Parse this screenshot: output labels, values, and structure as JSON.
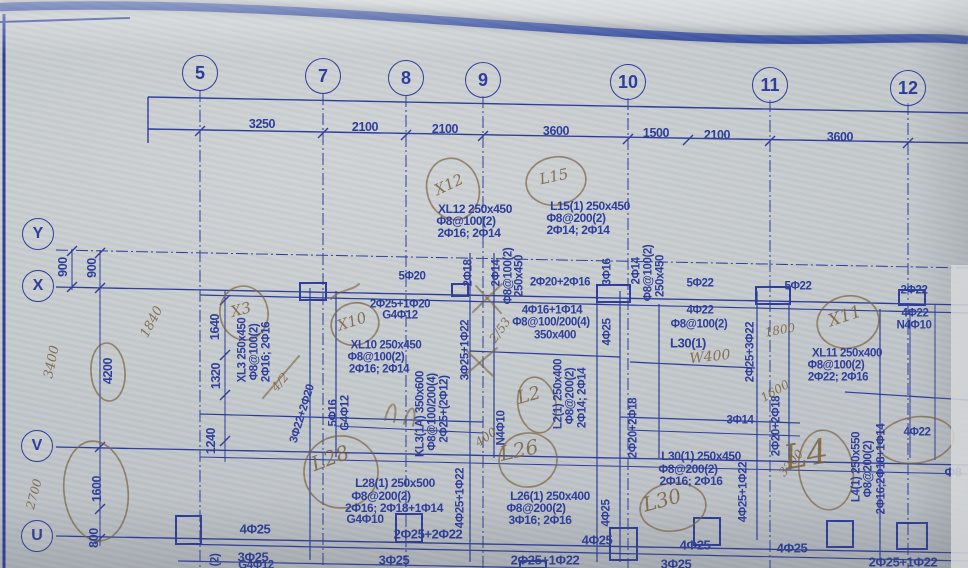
{
  "meta": {
    "description": "Photographed structural beam reinforcement layout blueprint with handwritten site markups"
  },
  "colors": {
    "ink": "#2c3c9b",
    "band": "#1d3795",
    "pen": "rgba(122,95,60,0.8)",
    "paper": "#c6cbce"
  },
  "grid": {
    "top_bubbles": [
      {
        "t": "5",
        "x": 200,
        "y": 73
      },
      {
        "t": "7",
        "x": 323,
        "y": 76
      },
      {
        "t": "8",
        "x": 406,
        "y": 78
      },
      {
        "t": "9",
        "x": 483,
        "y": 80
      },
      {
        "t": "10",
        "x": 628,
        "y": 82
      },
      {
        "t": "11",
        "x": 770,
        "y": 85
      },
      {
        "t": "12",
        "x": 908,
        "y": 88
      }
    ],
    "left_bubbles": [
      {
        "t": "Y",
        "x": 38,
        "y": 234
      },
      {
        "t": "X",
        "x": 38,
        "y": 286
      },
      {
        "t": "V",
        "x": 37,
        "y": 446
      },
      {
        "t": "U",
        "x": 37,
        "y": 536
      }
    ]
  },
  "dimensions": {
    "top": [
      {
        "t": "3250",
        "x": 262,
        "y": 124
      },
      {
        "t": "2100",
        "x": 365,
        "y": 127
      },
      {
        "t": "2100",
        "x": 445,
        "y": 129
      },
      {
        "t": "3600",
        "x": 556,
        "y": 131
      },
      {
        "t": "1500",
        "x": 656,
        "y": 133
      },
      {
        "t": "2100",
        "x": 717,
        "y": 135
      },
      {
        "t": "3600",
        "x": 840,
        "y": 137
      }
    ],
    "left": [
      {
        "t": "900",
        "x": 63,
        "y": 267,
        "r": -90
      },
      {
        "t": "900",
        "x": 92,
        "y": 268,
        "r": -90
      },
      {
        "t": "4200",
        "x": 108,
        "y": 371,
        "r": -90
      },
      {
        "t": "1600",
        "x": 97,
        "y": 489,
        "r": -90
      },
      {
        "t": "800",
        "x": 94,
        "y": 538,
        "r": -90
      },
      {
        "t": "1640",
        "x": 215,
        "y": 327,
        "r": -90
      },
      {
        "t": "1320",
        "x": 216,
        "y": 376,
        "r": -90
      },
      {
        "t": "1240",
        "x": 211,
        "y": 441,
        "r": -90
      }
    ]
  },
  "print_labels": [
    {
      "t": "XL12 250x450",
      "x": 475,
      "y": 209,
      "s": 12
    },
    {
      "t": "Φ8@100(2)",
      "x": 466,
      "y": 221,
      "s": 12
    },
    {
      "t": "2Φ16; 2Φ14",
      "x": 469,
      "y": 233,
      "s": 12
    },
    {
      "t": "L15(1) 250x450",
      "x": 590,
      "y": 206,
      "s": 12
    },
    {
      "t": "Φ8@200(2)",
      "x": 576,
      "y": 218,
      "s": 12
    },
    {
      "t": "2Φ14; 2Φ14",
      "x": 578,
      "y": 230,
      "s": 12
    },
    {
      "t": "5Φ20",
      "x": 412,
      "y": 277
    },
    {
      "t": "2Φ25+1Φ20",
      "x": 400,
      "y": 305
    },
    {
      "t": "G4Φ12",
      "x": 400,
      "y": 316
    },
    {
      "t": "XL10 250x450",
      "x": 386,
      "y": 346
    },
    {
      "t": "Φ8@100(2)",
      "x": 376,
      "y": 358
    },
    {
      "t": "2Φ16; 2Φ14",
      "x": 379,
      "y": 370
    },
    {
      "t": "2Φ20+2Φ16",
      "x": 560,
      "y": 283
    },
    {
      "t": "4Φ16+1Φ14",
      "x": 552,
      "y": 311
    },
    {
      "t": "Φ8@100/200(4)",
      "x": 551,
      "y": 323
    },
    {
      "t": "350x400",
      "x": 555,
      "y": 336
    },
    {
      "t": "5Φ22",
      "x": 700,
      "y": 284
    },
    {
      "t": "5Φ22",
      "x": 798,
      "y": 287
    },
    {
      "t": "2Φ22",
      "x": 914,
      "y": 291
    },
    {
      "t": "4Φ22",
      "x": 700,
      "y": 311
    },
    {
      "t": "Φ8@100(2)",
      "x": 699,
      "y": 325
    },
    {
      "t": "L30(1)",
      "x": 688,
      "y": 343,
      "s": 13
    },
    {
      "t": "4Φ22",
      "x": 915,
      "y": 314
    },
    {
      "t": "N4Φ10",
      "x": 914,
      "y": 326
    },
    {
      "t": "XL11 250x400",
      "x": 847,
      "y": 354
    },
    {
      "t": "Φ8@100(2)",
      "x": 836,
      "y": 366
    },
    {
      "t": "2Φ22; 2Φ16",
      "x": 838,
      "y": 378
    },
    {
      "t": "L28(1) 250x500",
      "x": 395,
      "y": 483,
      "s": 12
    },
    {
      "t": "Φ8@200(2)",
      "x": 381,
      "y": 496,
      "s": 12
    },
    {
      "t": "2Φ16; 2Φ18+1Φ14",
      "x": 394,
      "y": 508,
      "s": 12
    },
    {
      "t": "G4Φ10",
      "x": 365,
      "y": 519,
      "s": 12
    },
    {
      "t": "L26(1) 250x400",
      "x": 550,
      "y": 496,
      "s": 12
    },
    {
      "t": "Φ8@200(2)",
      "x": 536,
      "y": 508,
      "s": 12
    },
    {
      "t": "3Φ16; 2Φ16",
      "x": 540,
      "y": 520,
      "s": 12
    },
    {
      "t": "L30(1) 250x450",
      "x": 701,
      "y": 456,
      "s": 12
    },
    {
      "t": "Φ8@200(2)",
      "x": 688,
      "y": 469,
      "s": 12
    },
    {
      "t": "2Φ16; 2Φ16",
      "x": 691,
      "y": 481,
      "s": 12
    },
    {
      "t": "3Φ14",
      "x": 740,
      "y": 421
    },
    {
      "t": "4Φ22",
      "x": 917,
      "y": 433
    },
    {
      "t": "Φ8",
      "x": 953,
      "y": 472,
      "s": 13
    },
    {
      "t": "4Φ25",
      "x": 255,
      "y": 529,
      "s": 13
    },
    {
      "t": "3Φ25",
      "x": 253,
      "y": 557,
      "s": 13
    },
    {
      "t": "G4Φ12",
      "x": 256,
      "y": 566
    },
    {
      "t": "2Φ25+2Φ22",
      "x": 428,
      "y": 534,
      "s": 13
    },
    {
      "t": "3Φ25",
      "x": 394,
      "y": 560,
      "s": 13
    },
    {
      "t": "4Φ25",
      "x": 597,
      "y": 540,
      "s": 13
    },
    {
      "t": "2Φ25+1Φ22",
      "x": 545,
      "y": 560,
      "s": 13
    },
    {
      "t": "4Φ25",
      "x": 695,
      "y": 545,
      "s": 13
    },
    {
      "t": "3Φ25",
      "x": 676,
      "y": 564,
      "s": 13
    },
    {
      "t": "4Φ25",
      "x": 792,
      "y": 548,
      "s": 13
    },
    {
      "t": "2Φ25+1Φ22",
      "x": 903,
      "y": 562,
      "s": 13
    },
    {
      "t": "2Φ18",
      "x": 469,
      "y": 273,
      "r": -90
    },
    {
      "t": "2Φ14",
      "x": 497,
      "y": 273,
      "r": -90
    },
    {
      "t": "Φ8@100(2)",
      "x": 509,
      "y": 276,
      "r": -90
    },
    {
      "t": "250x450",
      "x": 520,
      "y": 276,
      "r": -90
    },
    {
      "t": "3Φ16",
      "x": 608,
      "y": 272,
      "r": -90
    },
    {
      "t": "2Φ14",
      "x": 637,
      "y": 271,
      "r": -90
    },
    {
      "t": "Φ8@100(2)",
      "x": 649,
      "y": 273,
      "r": -90
    },
    {
      "t": "250x450",
      "x": 661,
      "y": 276,
      "r": -90
    },
    {
      "t": "XL3 250x450",
      "x": 243,
      "y": 350,
      "r": -90
    },
    {
      "t": "Φ8@100(2)",
      "x": 255,
      "y": 352,
      "r": -90
    },
    {
      "t": "2Φ16; 2Φ16",
      "x": 267,
      "y": 352,
      "r": -90
    },
    {
      "t": "3Φ25+1Φ22",
      "x": 466,
      "y": 350,
      "r": -90
    },
    {
      "t": "3Φ22+2Φ20",
      "x": 303,
      "y": 414,
      "r": -73
    },
    {
      "t": "5Φ16",
      "x": 334,
      "y": 413,
      "r": -90
    },
    {
      "t": "G4Φ12",
      "x": 346,
      "y": 413,
      "r": -90
    },
    {
      "t": "KL3(1A) 350x600",
      "x": 421,
      "y": 414,
      "r": -90
    },
    {
      "t": "Φ8@100/200(4)",
      "x": 433,
      "y": 412,
      "r": -90
    },
    {
      "t": "2Φ25+(2Φ12)",
      "x": 445,
      "y": 409,
      "r": -90
    },
    {
      "t": "L2(1) 250x400",
      "x": 559,
      "y": 394,
      "r": -90
    },
    {
      "t": "Φ8@200(2)",
      "x": 571,
      "y": 396,
      "r": -90
    },
    {
      "t": "2Φ14; 2Φ14",
      "x": 583,
      "y": 398,
      "r": -90
    },
    {
      "t": "N4Φ10",
      "x": 502,
      "y": 428,
      "r": -90
    },
    {
      "t": "4Φ25",
      "x": 608,
      "y": 332,
      "r": -90
    },
    {
      "t": "4Φ25",
      "x": 607,
      "y": 513,
      "r": -90
    },
    {
      "t": "4Φ25+1Φ22",
      "x": 461,
      "y": 498,
      "r": -90
    },
    {
      "t": "4Φ25+1Φ22",
      "x": 744,
      "y": 492,
      "r": -90
    },
    {
      "t": "2Φ25+3Φ22",
      "x": 751,
      "y": 352,
      "r": -90
    },
    {
      "t": "2Φ20+2Φ18",
      "x": 634,
      "y": 428,
      "r": -90
    },
    {
      "t": "2Φ20+2Φ18",
      "x": 777,
      "y": 426,
      "r": -90
    },
    {
      "t": "L4(1) 250x550",
      "x": 857,
      "y": 467,
      "r": -90
    },
    {
      "t": "Φ8@200(2)",
      "x": 869,
      "y": 469,
      "r": -90
    },
    {
      "t": "2Φ16;2Φ18+1Φ14",
      "x": 882,
      "y": 469,
      "r": -90
    },
    {
      "t": "(2)",
      "x": 216,
      "y": 560,
      "r": -90
    }
  ],
  "handwritten": {
    "notes": [
      {
        "t": "X12",
        "x": 449,
        "y": 185,
        "r": -25,
        "s": 15
      },
      {
        "t": "L15",
        "x": 554,
        "y": 177,
        "r": -12,
        "s": 15
      },
      {
        "t": "X10",
        "x": 352,
        "y": 322,
        "r": -18,
        "s": 15
      },
      {
        "t": "X3",
        "x": 241,
        "y": 310,
        "r": -15,
        "s": 15
      },
      {
        "t": "X11",
        "x": 845,
        "y": 317,
        "r": -18,
        "s": 17
      },
      {
        "t": "L28",
        "x": 330,
        "y": 458,
        "r": -20,
        "s": 20
      },
      {
        "t": "L2",
        "x": 529,
        "y": 396,
        "r": -15,
        "s": 18
      },
      {
        "t": "L26",
        "x": 519,
        "y": 450,
        "r": -12,
        "s": 20
      },
      {
        "t": "L30",
        "x": 662,
        "y": 500,
        "r": -15,
        "s": 20
      },
      {
        "t": "L4",
        "x": 806,
        "y": 455,
        "r": -10,
        "s": 34
      },
      {
        "t": "1840",
        "x": 152,
        "y": 322,
        "r": -62,
        "s": 13
      },
      {
        "t": "3400",
        "x": 52,
        "y": 362,
        "r": -78,
        "s": 13
      },
      {
        "t": "2700",
        "x": 34,
        "y": 494,
        "r": -75,
        "s": 12
      },
      {
        "t": "W400",
        "x": 710,
        "y": 357,
        "r": -6,
        "s": 14
      },
      {
        "t": "1800",
        "x": 780,
        "y": 330,
        "r": -10,
        "s": 12
      },
      {
        "t": "1600",
        "x": 775,
        "y": 391,
        "r": -30,
        "s": 12
      },
      {
        "t": "3200",
        "x": 791,
        "y": 463,
        "r": -50,
        "s": 12
      },
      {
        "t": "400",
        "x": 486,
        "y": 437,
        "r": -35,
        "s": 12
      },
      {
        "t": "2/53",
        "x": 500,
        "y": 330,
        "r": -55,
        "s": 12
      },
      {
        "t": "4/2",
        "x": 280,
        "y": 382,
        "r": -50,
        "s": 12
      }
    ],
    "ellipses": [
      {
        "x": 453,
        "y": 189,
        "rx": 26,
        "ry": 31,
        "r": -15
      },
      {
        "x": 556,
        "y": 181,
        "rx": 30,
        "ry": 24,
        "r": -10
      },
      {
        "x": 355,
        "y": 324,
        "rx": 24,
        "ry": 21,
        "r": -15
      },
      {
        "x": 244,
        "y": 313,
        "rx": 24,
        "ry": 27,
        "r": -10
      },
      {
        "x": 848,
        "y": 322,
        "rx": 31,
        "ry": 26,
        "r": -12
      },
      {
        "x": 341,
        "y": 472,
        "rx": 37,
        "ry": 36,
        "r": 0
      },
      {
        "x": 537,
        "y": 405,
        "rx": 19,
        "ry": 28,
        "r": -10
      },
      {
        "x": 528,
        "y": 460,
        "rx": 29,
        "ry": 27,
        "r": -8
      },
      {
        "x": 673,
        "y": 507,
        "rx": 33,
        "ry": 24,
        "r": -8
      },
      {
        "x": 826,
        "y": 470,
        "rx": 27,
        "ry": 40,
        "r": -8
      },
      {
        "x": 108,
        "y": 372,
        "rx": 17,
        "ry": 29,
        "r": -4
      },
      {
        "x": 96,
        "y": 491,
        "rx": 32,
        "ry": 50,
        "r": -6
      },
      {
        "x": 916,
        "y": 440,
        "rx": 38,
        "ry": 23,
        "r": -8
      }
    ],
    "strokes": [
      "M473,312 L502,284",
      "M476,286 L501,313",
      "M464,376 L497,348",
      "M466,350 L494,377",
      "M263,398 L299,356",
      "M385,420 C390,398 399,400 394,422",
      "M404,424 C409,402 418,404 413,426",
      "M331,299 C340,289 352,291 359,284"
    ]
  },
  "linework": {
    "top_band": "M0,7 C250,-2 520,30 720,38 C830,43 910,35 968,40",
    "segments": [
      [
        0,
        22,
        130,
        18,
        2,
        0
      ],
      [
        4,
        14,
        4,
        568,
        3,
        0
      ],
      [
        148,
        97,
        968,
        113,
        1.4,
        0
      ],
      [
        148,
        129,
        968,
        143,
        1.4,
        0
      ],
      [
        148,
        97,
        148,
        143,
        1.4,
        0
      ],
      [
        56,
        250,
        968,
        268,
        1,
        1
      ],
      [
        56,
        287,
        968,
        305,
        1.3,
        0
      ],
      [
        200,
        295,
        968,
        313,
        1.2,
        0
      ],
      [
        56,
        447,
        968,
        465,
        1.3,
        0
      ],
      [
        200,
        457,
        968,
        474,
        1,
        0
      ],
      [
        56,
        536,
        968,
        553,
        1.3,
        0
      ],
      [
        178,
        544,
        968,
        561,
        1.2,
        0
      ],
      [
        178,
        561,
        760,
        572,
        1.2,
        0
      ],
      [
        200,
        414,
        483,
        422,
        1.2,
        0
      ],
      [
        336,
        426,
        483,
        433,
        1,
        0
      ],
      [
        470,
        351,
        620,
        357,
        1.2,
        0
      ],
      [
        630,
        362,
        755,
        368,
        1.2,
        0
      ],
      [
        620,
        417,
        800,
        423,
        1.2,
        0
      ],
      [
        628,
        430,
        800,
        436,
        1,
        0
      ],
      [
        845,
        392,
        968,
        400,
        1.2,
        0
      ],
      [
        200,
        90,
        200,
        568,
        1,
        1
      ],
      [
        323,
        93,
        323,
        568,
        1,
        1
      ],
      [
        406,
        95,
        406,
        568,
        1,
        1
      ],
      [
        483,
        96,
        483,
        568,
        1,
        1
      ],
      [
        628,
        98,
        628,
        568,
        1,
        1
      ],
      [
        770,
        100,
        770,
        568,
        1,
        1
      ],
      [
        908,
        103,
        908,
        568,
        1,
        1
      ],
      [
        310,
        288,
        310,
        560,
        1.2,
        0
      ],
      [
        336,
        291,
        336,
        457,
        1.2,
        0
      ],
      [
        470,
        253,
        470,
        562,
        1.2,
        0
      ],
      [
        494,
        253,
        494,
        458,
        1.2,
        0
      ],
      [
        597,
        290,
        597,
        562,
        1.2,
        0
      ],
      [
        620,
        291,
        620,
        562,
        1.2,
        0
      ],
      [
        659,
        304,
        659,
        458,
        1.2,
        0
      ],
      [
        757,
        291,
        757,
        540,
        1.2,
        0
      ],
      [
        789,
        304,
        789,
        460,
        1.2,
        0
      ],
      [
        880,
        309,
        880,
        562,
        1.2,
        0
      ],
      [
        910,
        310,
        910,
        458,
        1,
        0
      ],
      [
        935,
        304,
        935,
        460,
        1,
        0
      ],
      [
        100,
        250,
        100,
        546,
        1,
        0
      ],
      [
        72,
        249,
        72,
        290,
        1,
        0
      ],
      [
        225,
        291,
        225,
        462,
        1,
        0
      ]
    ],
    "ticks": [
      [
        200,
        131
      ],
      [
        323,
        133
      ],
      [
        406,
        135
      ],
      [
        483,
        136
      ],
      [
        628,
        139
      ],
      [
        688,
        140
      ],
      [
        770,
        141
      ],
      [
        908,
        143
      ],
      [
        100,
        253
      ],
      [
        100,
        288
      ],
      [
        100,
        447
      ],
      [
        100,
        509
      ],
      [
        100,
        539
      ],
      [
        72,
        251
      ],
      [
        72,
        287
      ],
      [
        225,
        300
      ],
      [
        225,
        355
      ],
      [
        225,
        395
      ],
      [
        225,
        441
      ]
    ],
    "boxes": [
      [
        300,
        283,
        26,
        17
      ],
      [
        597,
        285,
        33,
        17
      ],
      [
        756,
        287,
        34,
        17
      ],
      [
        452,
        284,
        16,
        12
      ],
      [
        899,
        290,
        26,
        15
      ],
      [
        176,
        516,
        25,
        28
      ],
      [
        396,
        514,
        26,
        28
      ],
      [
        610,
        528,
        27,
        32
      ],
      [
        694,
        518,
        26,
        27
      ],
      [
        827,
        521,
        26,
        26
      ],
      [
        897,
        523,
        30,
        26
      ],
      [
        520,
        561,
        26,
        7
      ]
    ]
  }
}
